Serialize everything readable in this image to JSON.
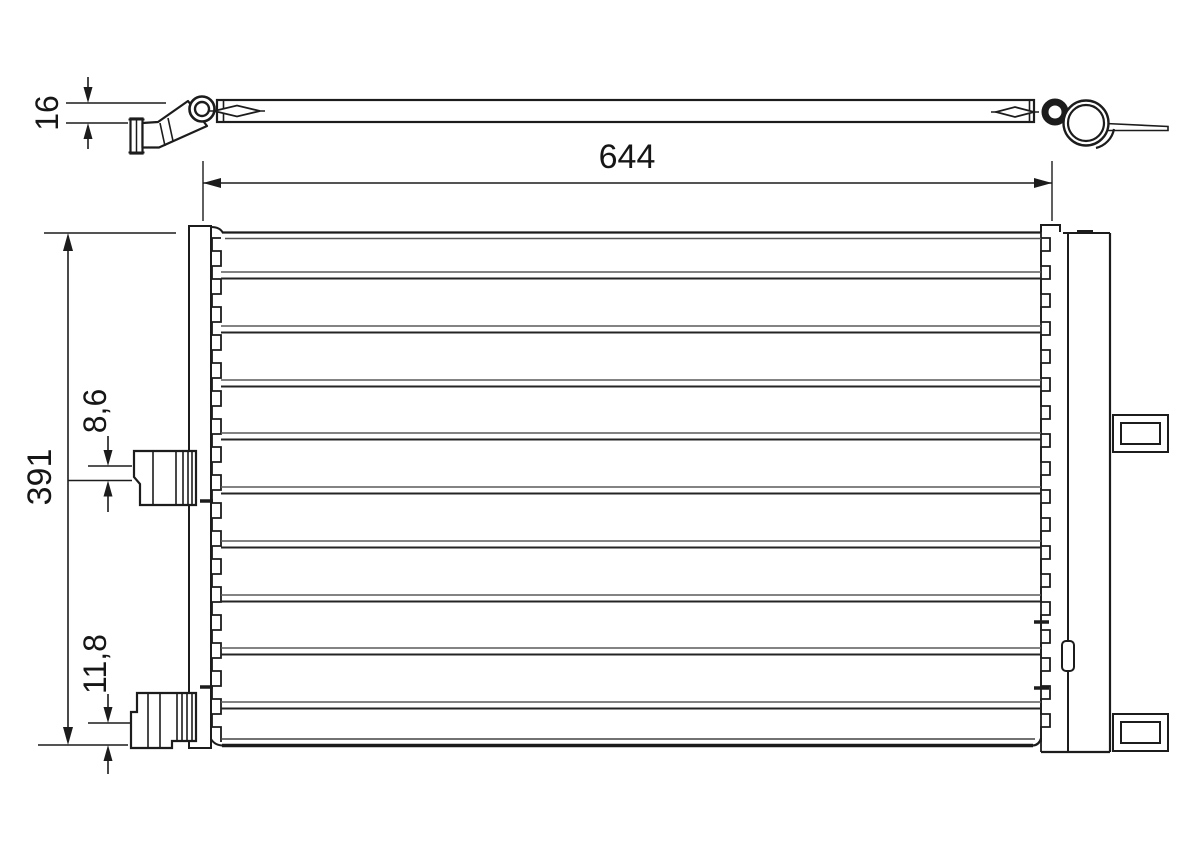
{
  "drawing": {
    "kind": "condenser-technical-drawing",
    "background": "#ffffff",
    "line_color": "#1c1c1c",
    "dimensions": {
      "core_width": "644",
      "core_height": "391",
      "profile_thickness": "16",
      "upper_connector": "8,6",
      "lower_connector": "11,8"
    }
  }
}
